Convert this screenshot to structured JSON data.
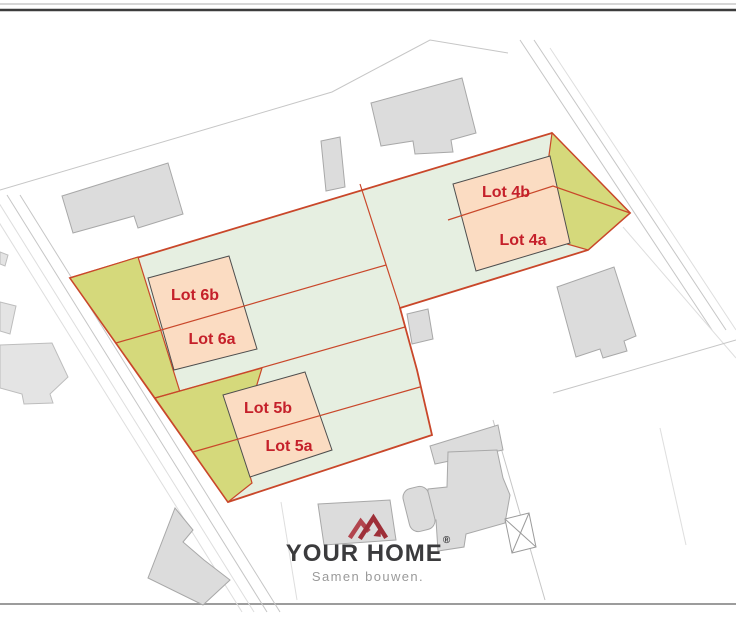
{
  "palette": {
    "parcel_green": "#e6efe1",
    "garden_olive": "#d5d97b",
    "envelope_peach": "#fbdcc2",
    "boundary_red": "#c9472a",
    "lot_text_red": "#c5202a",
    "building_gray": "#dcdcdc",
    "brand_dark": "#3b3b3d",
    "brand_red": "#9e2f38",
    "tagline_gray": "#9a9a9a"
  },
  "lots": {
    "l4b": {
      "label": "Lot 4b"
    },
    "l4a": {
      "label": "Lot 4a"
    },
    "l6b": {
      "label": "Lot 6b"
    },
    "l6a": {
      "label": "Lot 6a"
    },
    "l5b": {
      "label": "Lot 5b"
    },
    "l5a": {
      "label": "Lot 5a"
    }
  },
  "brand": {
    "name": "YOUR HOME",
    "registered": "®",
    "tagline": "Samen bouwen."
  }
}
